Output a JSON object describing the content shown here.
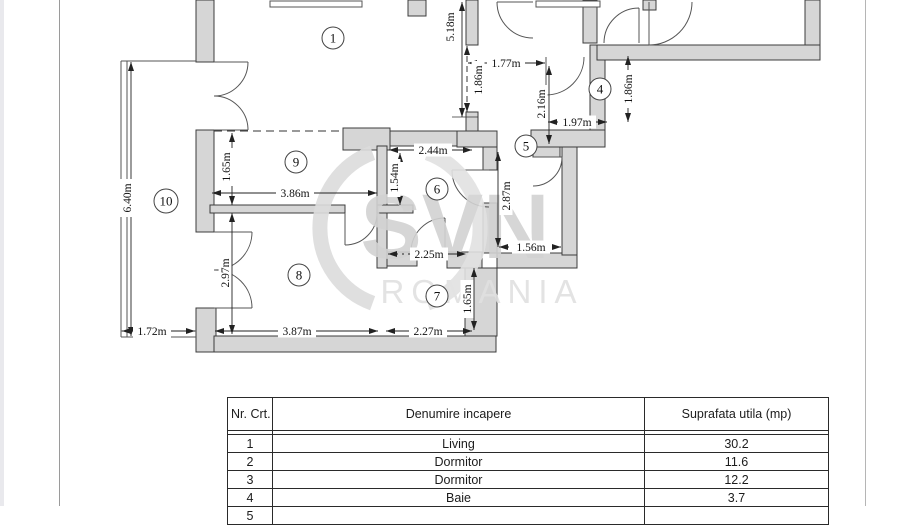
{
  "watermark": {
    "brand": "SVN",
    "region": "ROMANIA",
    "brand_color": "#d2d2d2",
    "region_color": "#e0e0e0"
  },
  "floorplan": {
    "rooms": [
      {
        "n": "1",
        "cx": 333,
        "cy": 38
      },
      {
        "n": "4",
        "cx": 600,
        "cy": 89
      },
      {
        "n": "5",
        "cx": 526,
        "cy": 146
      },
      {
        "n": "6",
        "cx": 437,
        "cy": 189
      },
      {
        "n": "9",
        "cx": 296,
        "cy": 162
      },
      {
        "n": "10",
        "cx": 166,
        "cy": 201
      },
      {
        "n": "8",
        "cx": 299,
        "cy": 275
      },
      {
        "n": "7",
        "cx": 437,
        "cy": 296
      }
    ],
    "dimensions": [
      {
        "t": "5.18m",
        "x1": 462,
        "y1": 2,
        "x2": 462,
        "y2": 117,
        "lx": 450,
        "ly": 27,
        "rot": 1,
        "st": 0
      },
      {
        "t": "1.77m",
        "x1": 468,
        "y1": 63,
        "x2": 545,
        "y2": 63,
        "lx": 506,
        "ly": 63,
        "rot": 0,
        "st": 0
      },
      {
        "t": "1.86m",
        "x1": 467,
        "y1": 46,
        "x2": 467,
        "y2": 112,
        "lx": 478,
        "ly": 80,
        "rot": 1,
        "st": 1
      },
      {
        "t": "2.16m",
        "x1": 549,
        "y1": 66,
        "x2": 549,
        "y2": 144,
        "lx": 541,
        "ly": 104,
        "rot": 1,
        "st": 0
      },
      {
        "t": "1.97m",
        "x1": 548,
        "y1": 122,
        "x2": 607,
        "y2": 122,
        "lx": 577,
        "ly": 122,
        "rot": 0,
        "st": 0
      },
      {
        "t": "1.86m",
        "x1": 628,
        "y1": 56,
        "x2": 628,
        "y2": 122,
        "lx": 628,
        "ly": 89,
        "rot": 1,
        "st": 0
      },
      {
        "t": "2.44m",
        "x1": 389,
        "y1": 150,
        "x2": 472,
        "y2": 150,
        "lx": 433,
        "ly": 150,
        "rot": 0,
        "st": 0
      },
      {
        "t": "1.54m",
        "x1": 400,
        "y1": 153,
        "x2": 400,
        "y2": 205,
        "lx": 394,
        "ly": 178,
        "rot": 1,
        "st": 0
      },
      {
        "t": "1.65m",
        "x1": 232,
        "y1": 133,
        "x2": 232,
        "y2": 205,
        "lx": 226,
        "ly": 167,
        "rot": 1,
        "st": 0
      },
      {
        "t": "3.86m",
        "x1": 212,
        "y1": 193,
        "x2": 377,
        "y2": 193,
        "lx": 295,
        "ly": 193,
        "rot": 0,
        "st": 0
      },
      {
        "t": "6.40m",
        "x1": 131,
        "y1": 62,
        "x2": 131,
        "y2": 336,
        "lx": 127,
        "ly": 198,
        "rot": 1,
        "st": 0
      },
      {
        "t": "1.72m",
        "x1": 122,
        "y1": 331,
        "x2": 195,
        "y2": 331,
        "lx": 152,
        "ly": 331,
        "rot": 0,
        "st": 0
      },
      {
        "t": "2.97m",
        "x1": 232,
        "y1": 213,
        "x2": 232,
        "y2": 334,
        "lx": 225,
        "ly": 273,
        "rot": 1,
        "st": 0
      },
      {
        "t": "3.87m",
        "x1": 215,
        "y1": 331,
        "x2": 378,
        "y2": 331,
        "lx": 297,
        "ly": 331,
        "rot": 0,
        "st": 0
      },
      {
        "t": "2.27m",
        "x1": 386,
        "y1": 331,
        "x2": 472,
        "y2": 331,
        "lx": 428,
        "ly": 331,
        "rot": 0,
        "st": 0
      },
      {
        "t": "1.65m",
        "x1": 474,
        "y1": 268,
        "x2": 474,
        "y2": 330,
        "lx": 467,
        "ly": 299,
        "rot": 1,
        "st": 0
      },
      {
        "t": "2.25m",
        "x1": 388,
        "y1": 254,
        "x2": 466,
        "y2": 254,
        "lx": 429,
        "ly": 254,
        "rot": 0,
        "st": 2
      },
      {
        "t": "1.56m",
        "x1": 499,
        "y1": 247,
        "x2": 561,
        "y2": 247,
        "lx": 531,
        "ly": 247,
        "rot": 0,
        "st": 2
      },
      {
        "t": "2.87m",
        "x1": 498,
        "y1": 152,
        "x2": 498,
        "y2": 247,
        "lx": 506,
        "ly": 196,
        "rot": 1,
        "st": 0
      }
    ]
  },
  "table": {
    "headers": [
      "Nr. Crt.",
      "Denumire incapere",
      "Suprafata utila (mp)"
    ],
    "rows": [
      {
        "nr": "1",
        "name": "Living",
        "area": "30.2"
      },
      {
        "nr": "2",
        "name": "Dormitor",
        "area": "11.6"
      },
      {
        "nr": "3",
        "name": "Dormitor",
        "area": "12.2"
      },
      {
        "nr": "4",
        "name": "Baie",
        "area": "3.7"
      },
      {
        "nr": "5",
        "name": "",
        "area": ""
      }
    ]
  }
}
